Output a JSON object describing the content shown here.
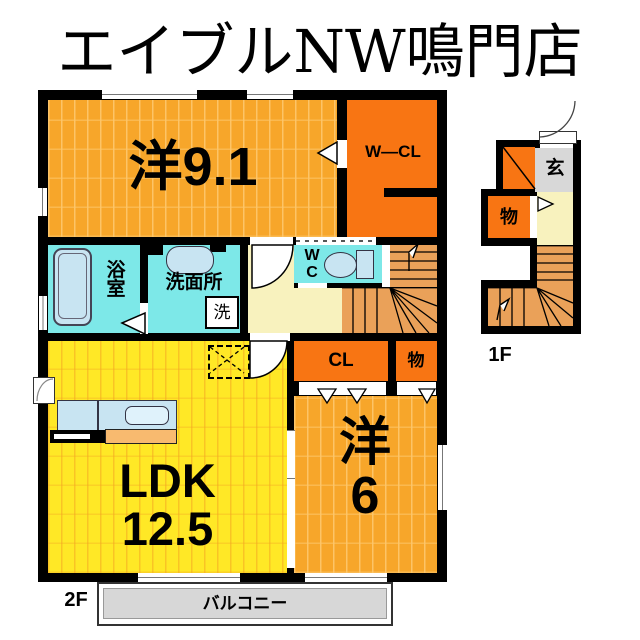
{
  "title": "エイブルNW鳴門店",
  "floor2": {
    "floor_label": "2F",
    "room_yo91": "洋9.1",
    "room_wcl": "W—CL",
    "room_bath_line1": "浴",
    "room_bath_line2": "室",
    "room_senmenjo": "洗面所",
    "washer": "洗",
    "wc_line1": "W",
    "wc_line2": "C",
    "closet_cl": "CL",
    "closet_mono": "物",
    "ldk_line1": "LDK",
    "ldk_line2": "12.5",
    "yo6_line1": "洋",
    "yo6_line2": "6",
    "balcony": "バルコニー"
  },
  "floor1": {
    "floor_label": "1F",
    "genkan": "玄",
    "mono": "物"
  },
  "icons": {
    "stairs_up_arrow": "walk-line-up-arrow",
    "door_swing": "quarter-circle-door-swing",
    "door_triangle": "door-direction-triangle"
  },
  "colors": {
    "wall": "#000000",
    "amber_room": "#F7A62A",
    "amber_plank": "#FDC66A",
    "yellow_ldk": "#FFE826",
    "dark_orange_closet": "#F87513",
    "cyan_wet_area": "#7DE8E8",
    "cream_hall": "#F8F2BE",
    "stairs_tan": "#EAA159",
    "gray_area": "#D8D8D8",
    "fixture_blue": "#C8E4F2"
  }
}
